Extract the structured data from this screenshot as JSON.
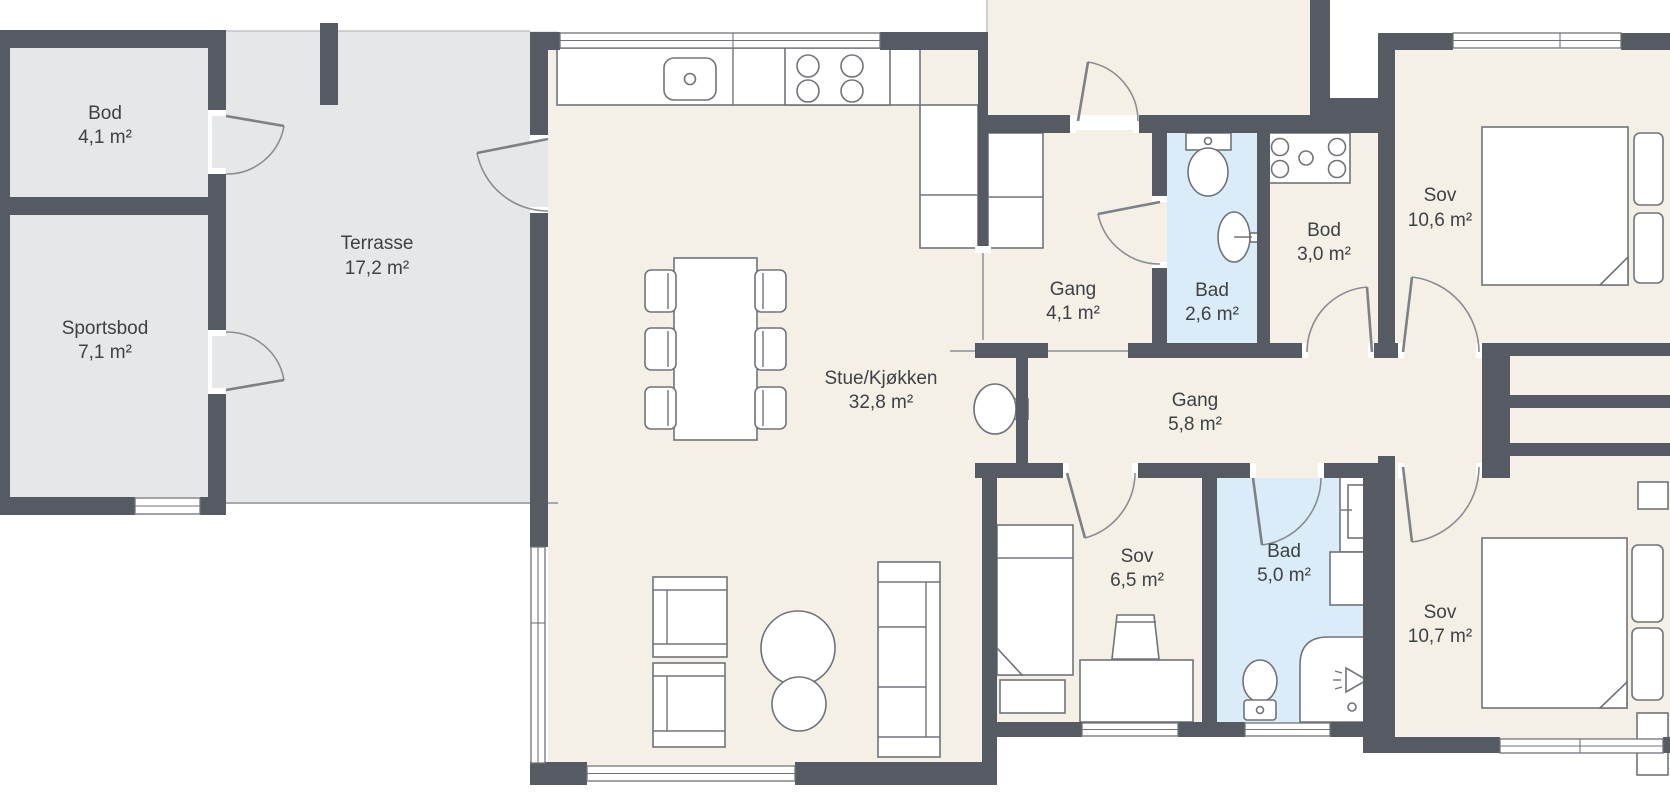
{
  "plan": {
    "rooms": {
      "bod_left": {
        "name": "Bod",
        "area": "4,1 m²"
      },
      "sportsbod": {
        "name": "Sportsbod",
        "area": "7,1 m²"
      },
      "terrasse": {
        "name": "Terrasse",
        "area": "17,2 m²"
      },
      "stue_kjokken": {
        "name": "Stue/Kjøkken",
        "area": "32,8 m²"
      },
      "gang_entre": {
        "name": "Gang",
        "area": "4,1 m²"
      },
      "bad_small": {
        "name": "Bad",
        "area": "2,6 m²"
      },
      "bod_inner": {
        "name": "Bod",
        "area": "3,0 m²"
      },
      "sov_ne": {
        "name": "Sov",
        "area": "10,6 m²"
      },
      "gang_main": {
        "name": "Gang",
        "area": "5,8 m²"
      },
      "sov_small": {
        "name": "Sov",
        "area": "6,5 m²"
      },
      "bad_large": {
        "name": "Bad",
        "area": "5,0 m²"
      },
      "sov_se": {
        "name": "Sov",
        "area": "10,7 m²"
      }
    },
    "colors": {
      "wall": "#565a62",
      "interior_floor": "#f4f0e6",
      "outdoor_floor": "#e6e7e9",
      "bathroom_floor": "#daecf8",
      "furniture_outline": "#70737a",
      "label_text": "#3e4145"
    },
    "fixture_icons": [
      "kitchen-sink-icon",
      "stove-burners-icon",
      "kitchen-cabinet-icon",
      "hall-closet-icon",
      "dining-table-icon",
      "dining-chair-icon",
      "fireplace-icon",
      "armchair-icon",
      "coffee-table-icon",
      "sofa-icon",
      "toilet-icon",
      "wash-basin-icon",
      "washing-machine-icon",
      "single-bed-icon",
      "nightstand-icon",
      "desk-icon",
      "desk-chair-icon",
      "double-bed-icon",
      "pillow-icon",
      "shower-icon",
      "bathroom-vanity-icon",
      "window",
      "door-swing-arc"
    ]
  }
}
